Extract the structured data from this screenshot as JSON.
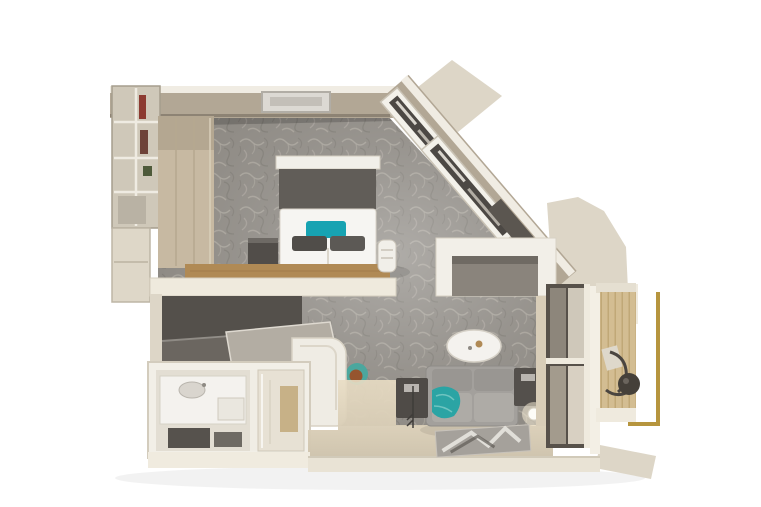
{
  "palette": {
    "bg": "#ffffff",
    "wall_face": "#b2a795",
    "wall_lip": "#f0ece3",
    "wall_cream": "#ddd6c7",
    "wall_white": "#efeade",
    "carpet_base": "#8f8b85",
    "carpet_stroke_light": "#aba69e",
    "carpet_stroke_dark": "#7a766f",
    "dark_furniture": "#514d49",
    "headboard": "#615d58",
    "bed_white": "#f6f5f2",
    "pillow_teal": "#17a3b2",
    "pillow_gray": "#504d49",
    "wood_bench": "#b08a55",
    "wood_panel": "#c7b9a2",
    "balcony_wood": "#d3bd92",
    "sofa_gray": "#a3a09c",
    "sofa_cushion": "#aeaba6",
    "throw_teal": "#2ba4a4",
    "table_white": "#f4f2ee",
    "railing_gold": "#b6953e",
    "glass_dark": "#8d867b",
    "glass_light": "#cfc8ba",
    "floor_beige": "#d3c8b3",
    "fixture_white": "#f4f2ee",
    "stool_teal": "#4ba79e",
    "stool_brown": "#96552f",
    "shelf_item_red": "#8c3a31",
    "shelf_item_green": "#4e5a3a",
    "rug_gray": "#a5a19b",
    "rug_light": "#e8e5e0",
    "curtain_beige": "#d8cdb8"
  },
  "floor_plan": {
    "render_style": "photorealistic top-down 3D cutaway of a hotel/cruise suite on white background",
    "rooms": [
      {
        "name": "bedroom",
        "items": [
          "open-shelf-unit",
          "closet-panels",
          "ceiling-light",
          "headboard-shelf",
          "headboard",
          "double-bed",
          "teal-accent-pillow",
          "two-gray-pillows",
          "dark-nightstand",
          "wood-foot-bench",
          "white-bedside-stool"
        ]
      },
      {
        "name": "dressing-corridor",
        "items": [
          "dark-closet-fronts",
          "luggage-bench",
          "teal-vanity-stool"
        ]
      },
      {
        "name": "bathroom",
        "items": [
          "vanity-counter",
          "sink",
          "shower-enclosure",
          "dark-floor-mats",
          "wc-enclosure"
        ]
      },
      {
        "name": "living-room",
        "items": [
          "diagonal-window-wall",
          "desk-media-unit",
          "dark-tv-shelf",
          "oval-coffee-table",
          "two-seat-sofa",
          "teal-throw",
          "left-side-table",
          "right-side-table",
          "arc-floor-lamp",
          "glowing-floor-lamp",
          "area-rug",
          "entry-floor"
        ]
      },
      {
        "name": "balcony",
        "items": [
          "sliding-glass-door",
          "curtain",
          "wood-deck",
          "lounge-chair",
          "round-side-table",
          "gold-railing"
        ]
      }
    ],
    "carpet": "gray leaf-patterned carpet throughout bedroom and living area",
    "accent_color_note": "teal accents on pillows, throw and stool; brass/gold balcony railing"
  }
}
